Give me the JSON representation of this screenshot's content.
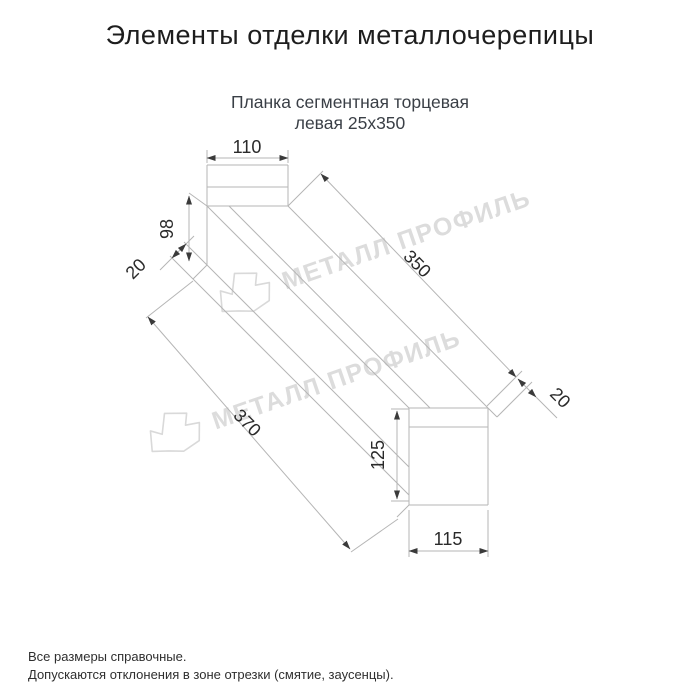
{
  "header": {
    "title": "Элементы отделки металлочерепицы"
  },
  "product": {
    "subtitle_line1": "Планка сегментная торцевая",
    "subtitle_line2": "левая 25х350"
  },
  "drawing": {
    "type": "isometric technical drawing of left segmented end trim plank",
    "dimensions": {
      "cap_width": "110",
      "web_height": "98",
      "top_hem": "20",
      "flange_length": "350",
      "bottom_hem": "20",
      "overall_length": "370",
      "end_height": "125",
      "end_width": "115"
    }
  },
  "watermark": {
    "text": "МЕТАЛЛ ПРОФИЛЬ"
  },
  "footer": {
    "line1": "Все размеры справочные.",
    "line2": "Допускаются отклонения в зоне отрезки (смятие, заусенцы)."
  },
  "colors": {
    "background": "#ffffff",
    "title_text": "#1d1d1d",
    "subtitle_text": "#3a3f46",
    "drawing_lines": "#b5b5b5",
    "dimension_text": "#2a2a2a",
    "arrowheads": "#3a3a3a",
    "watermark": "#dcdcdc"
  }
}
